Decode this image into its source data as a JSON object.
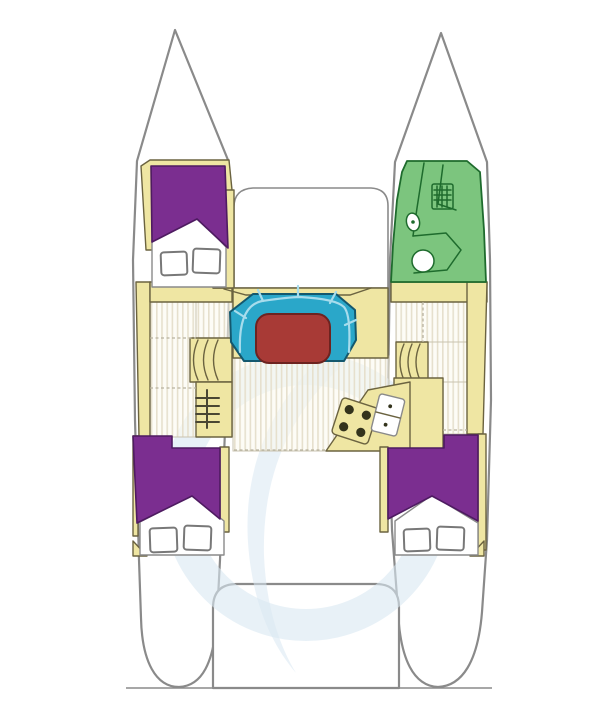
{
  "meta": {
    "description": "catamaran-sailboat-deck-plan-top-view",
    "orientation": "bow-up"
  },
  "colors": {
    "background": "#ffffff",
    "hull_fill": "#ffffff",
    "hull_stroke": "#8a8a8a",
    "deck_cream": "#efe6a3",
    "deck_line": "#6b6340",
    "cabin_purple": "#7b2e90",
    "cabin_purple_stroke": "#4e1b61",
    "head_green": "#7cc57e",
    "head_green_stroke": "#1e6b2d",
    "settee_teal": "#2aa7c9",
    "settee_stroke": "#14586e",
    "settee_seam": "#a7dcec",
    "table_red": "#a83a36",
    "table_stroke": "#6d2320",
    "floor_base": "#fbf9ef",
    "floor_stripe": "#e6e0cd",
    "floor_edge": "#c9c3b0",
    "fixture_white": "#ffffff",
    "fixture_stroke": "#787878",
    "burner_dark": "#33331c",
    "ladder_dark": "#4a4733",
    "watermark_blue": "#d9e7f2",
    "divider_dash": "#b9b3a0",
    "baseline": "#8a8a8a"
  },
  "regions": {
    "port_forward_cabin": "v-berth-cabin",
    "starboard_forward_head": "bathroom-head",
    "foredeck": "bridgedeck-foredeck",
    "salon": "u-settee-with-dining-table",
    "galley": "angled-counter-with-stove-and-sink",
    "port_aft_cabin": "double-berth-cabin",
    "starboard_aft_cabin": "double-berth-cabin",
    "cockpit": "aft-deck-with-transom-platform",
    "watermark": "light-blue-circular-logo"
  },
  "fixtures": {
    "stove_burners": 4,
    "sink_basins": 2,
    "deck_hatches": 6,
    "toilet": 1,
    "washbasin": 1,
    "shower_vent_grid": 1,
    "ladder_rungs": 4,
    "companionway_step_arcs_per_side": 3
  }
}
